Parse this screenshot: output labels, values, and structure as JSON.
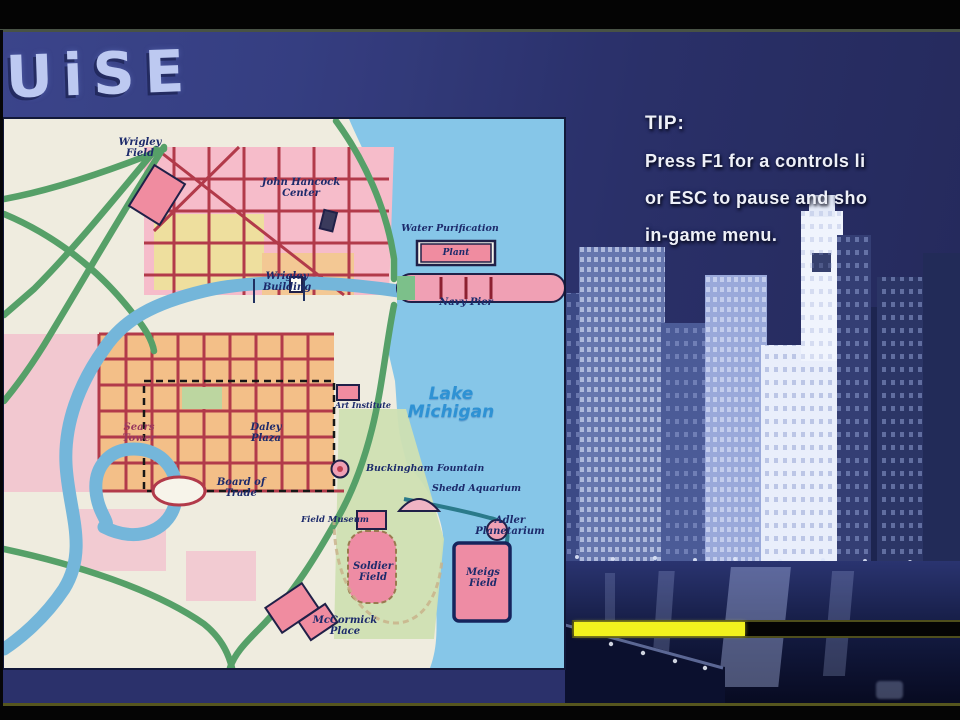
{
  "game": {
    "screen_title": "UiSE"
  },
  "tip": {
    "heading": "TIP:",
    "lines": [
      "Press F1 for a controls li",
      "or ESC to pause and sho",
      "in-game menu."
    ]
  },
  "map": {
    "lake_label": "Lake\nMichigan",
    "plant_box": "Plant",
    "labels": [
      {
        "id": "wrigley-field",
        "text": "Wrigley\nField"
      },
      {
        "id": "john-hancock-center",
        "text": "John Hancock\nCenter"
      },
      {
        "id": "water-purification",
        "text": "Water Purification"
      },
      {
        "id": "navy-pier",
        "text": "Navy Pier"
      },
      {
        "id": "wrigley-building",
        "text": "Wrigley\nBuilding"
      },
      {
        "id": "sears-tower",
        "text": "Sears\nTower"
      },
      {
        "id": "daley-plaza",
        "text": "Daley\nPlaza"
      },
      {
        "id": "art-institute",
        "text": "Art Institute"
      },
      {
        "id": "board-of-trade",
        "text": "Board of\nTrade"
      },
      {
        "id": "buckingham-fountain",
        "text": "Buckingham Fountain"
      },
      {
        "id": "shedd-aquarium",
        "text": "Shedd Aquarium"
      },
      {
        "id": "adler-planetarium",
        "text": "Adler\nPlanetarium"
      },
      {
        "id": "field-museum",
        "text": "Field Museum"
      },
      {
        "id": "soldier-field",
        "text": "Soldier\nField"
      },
      {
        "id": "meigs-field",
        "text": "Meigs\nField"
      },
      {
        "id": "mccormick-place",
        "text": "McCormick\nPlace"
      }
    ]
  },
  "loading": {
    "percent": 43
  },
  "colors": {
    "lake": "#86c6e8",
    "land": "#efecdf",
    "loop_orange": "#f3bf88",
    "north_pink": "#f6bcca",
    "highway_green": "#56a068",
    "street_crimson": "#b23a4a",
    "river_blue": "#74b6da",
    "loading_yellow": "#f2f21e",
    "sky_blue": "#2b316b",
    "label_navy": "#1c2a6b"
  }
}
